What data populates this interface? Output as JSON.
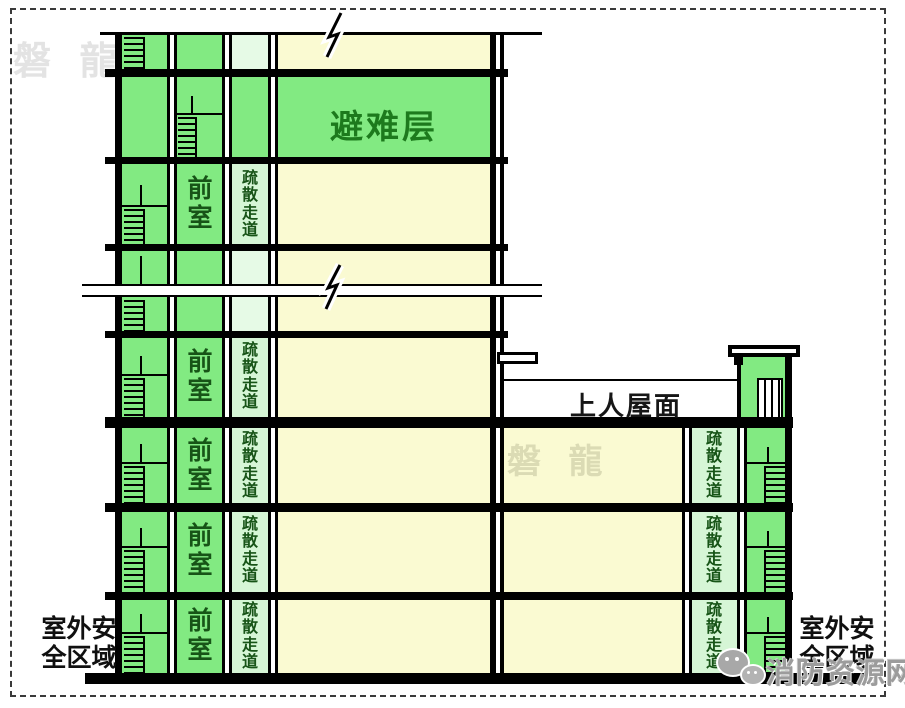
{
  "labels": {
    "refuge_floor": "避难层",
    "front_room": "前室",
    "evacuation_corridor": "疏散走道",
    "accessible_roof": "上人屋面",
    "outdoor_line1": "室外安",
    "outdoor_line2": "全区域"
  },
  "watermarks": {
    "top_left": "磐 龍",
    "center": "磐 龍"
  },
  "footer_logo": {
    "text": "消防资源网",
    "icon": "wechat-bubbles-icon"
  },
  "colors": {
    "safe_zone_green": "#82ea82",
    "corridor_pale_green": "#d6f6d6",
    "corridor_light_green": "#e6fae6",
    "floor_yellow": "#fafad2",
    "label_dark_green": "#175417",
    "refuge_label_green": "#1d7a1d",
    "line_black": "#000000",
    "logo_gray": "#9c9c9c"
  }
}
